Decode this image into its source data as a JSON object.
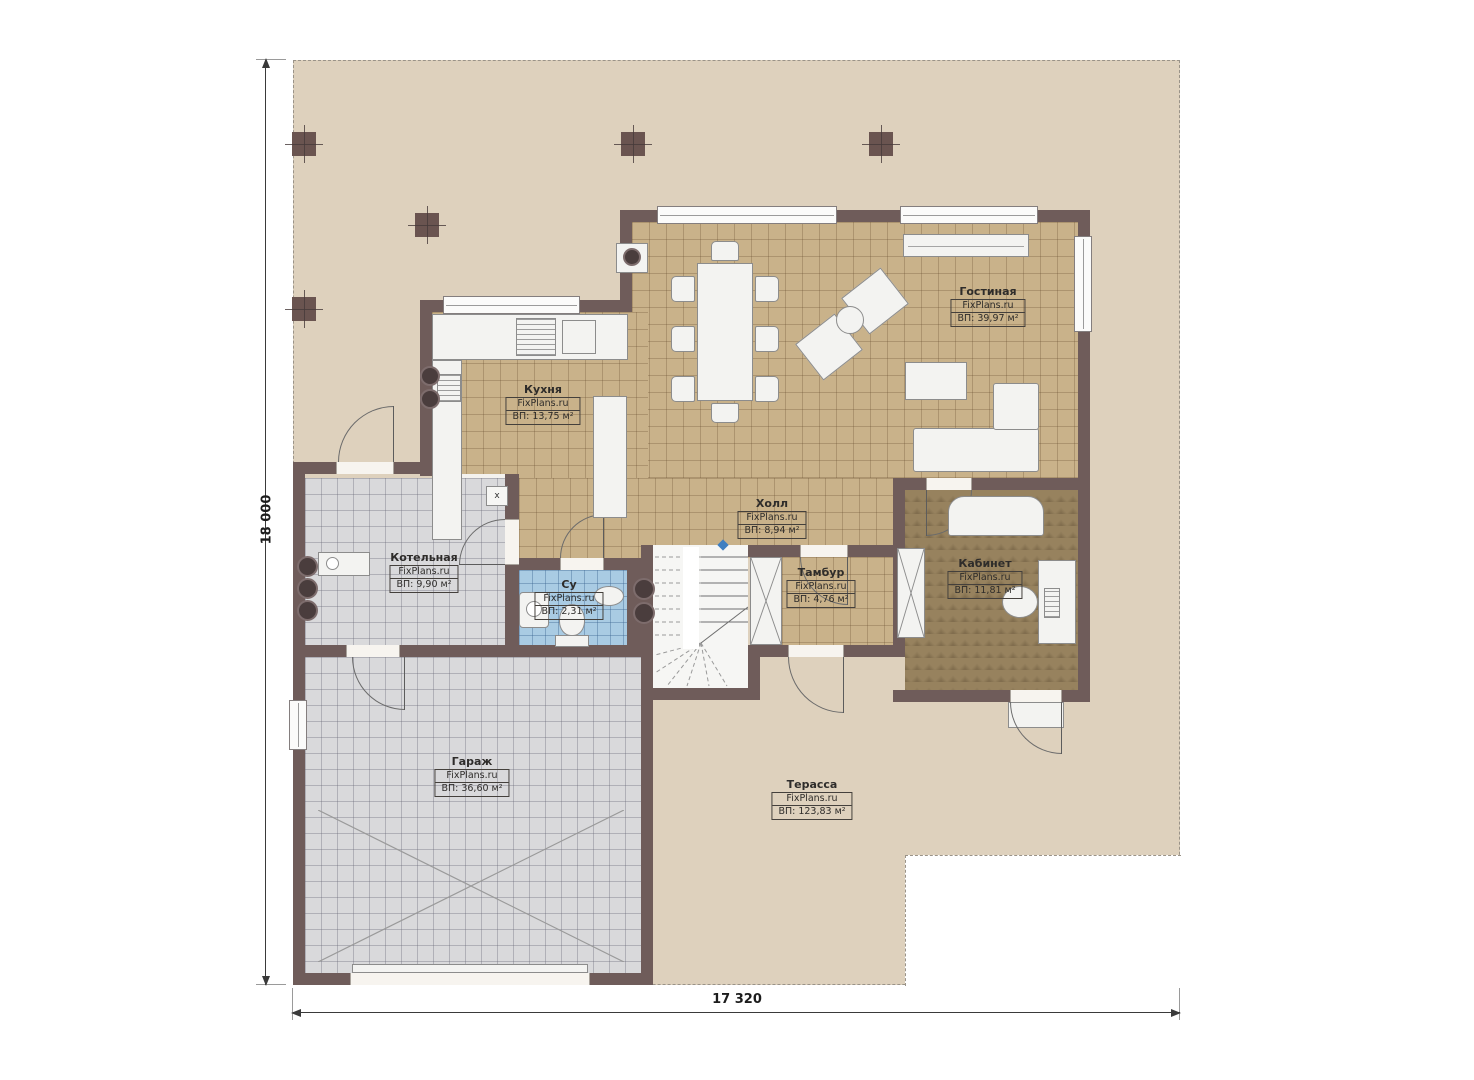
{
  "plan": {
    "watermark": "FixPlans.ru",
    "duct_label": "x",
    "dimensions": {
      "height_label": "18 000",
      "width_label": "17 320"
    },
    "rooms": [
      {
        "id": "living",
        "name": "Гостиная",
        "area_label": "ВП: 39,97 м²"
      },
      {
        "id": "kitchen",
        "name": "Кухня",
        "area_label": "ВП: 13,75 м²"
      },
      {
        "id": "hall",
        "name": "Холл",
        "area_label": "ВП: 8,94 м²"
      },
      {
        "id": "boiler",
        "name": "Котельная",
        "area_label": "ВП: 9,90 м²"
      },
      {
        "id": "bathroom",
        "name": "Су",
        "area_label": "ВП: 2,31 м²"
      },
      {
        "id": "tambour",
        "name": "Тамбур",
        "area_label": "ВП: 4,76 м²"
      },
      {
        "id": "study",
        "name": "Кабинет",
        "area_label": "ВП: 11,81 м²"
      },
      {
        "id": "garage",
        "name": "Гараж",
        "area_label": "ВП: 36,60 м²"
      },
      {
        "id": "terrace",
        "name": "Терасса",
        "area_label": "ВП: 123,83 м²"
      }
    ],
    "colors": {
      "wall": "#6f5c5a",
      "site": "#ded1bd",
      "floor_tan": "#c9b28a",
      "floor_gray": "#d9d9db",
      "floor_blue": "#a9cbe3",
      "floor_study": "#97825e",
      "accent_blue": "#3f7fc1"
    }
  }
}
